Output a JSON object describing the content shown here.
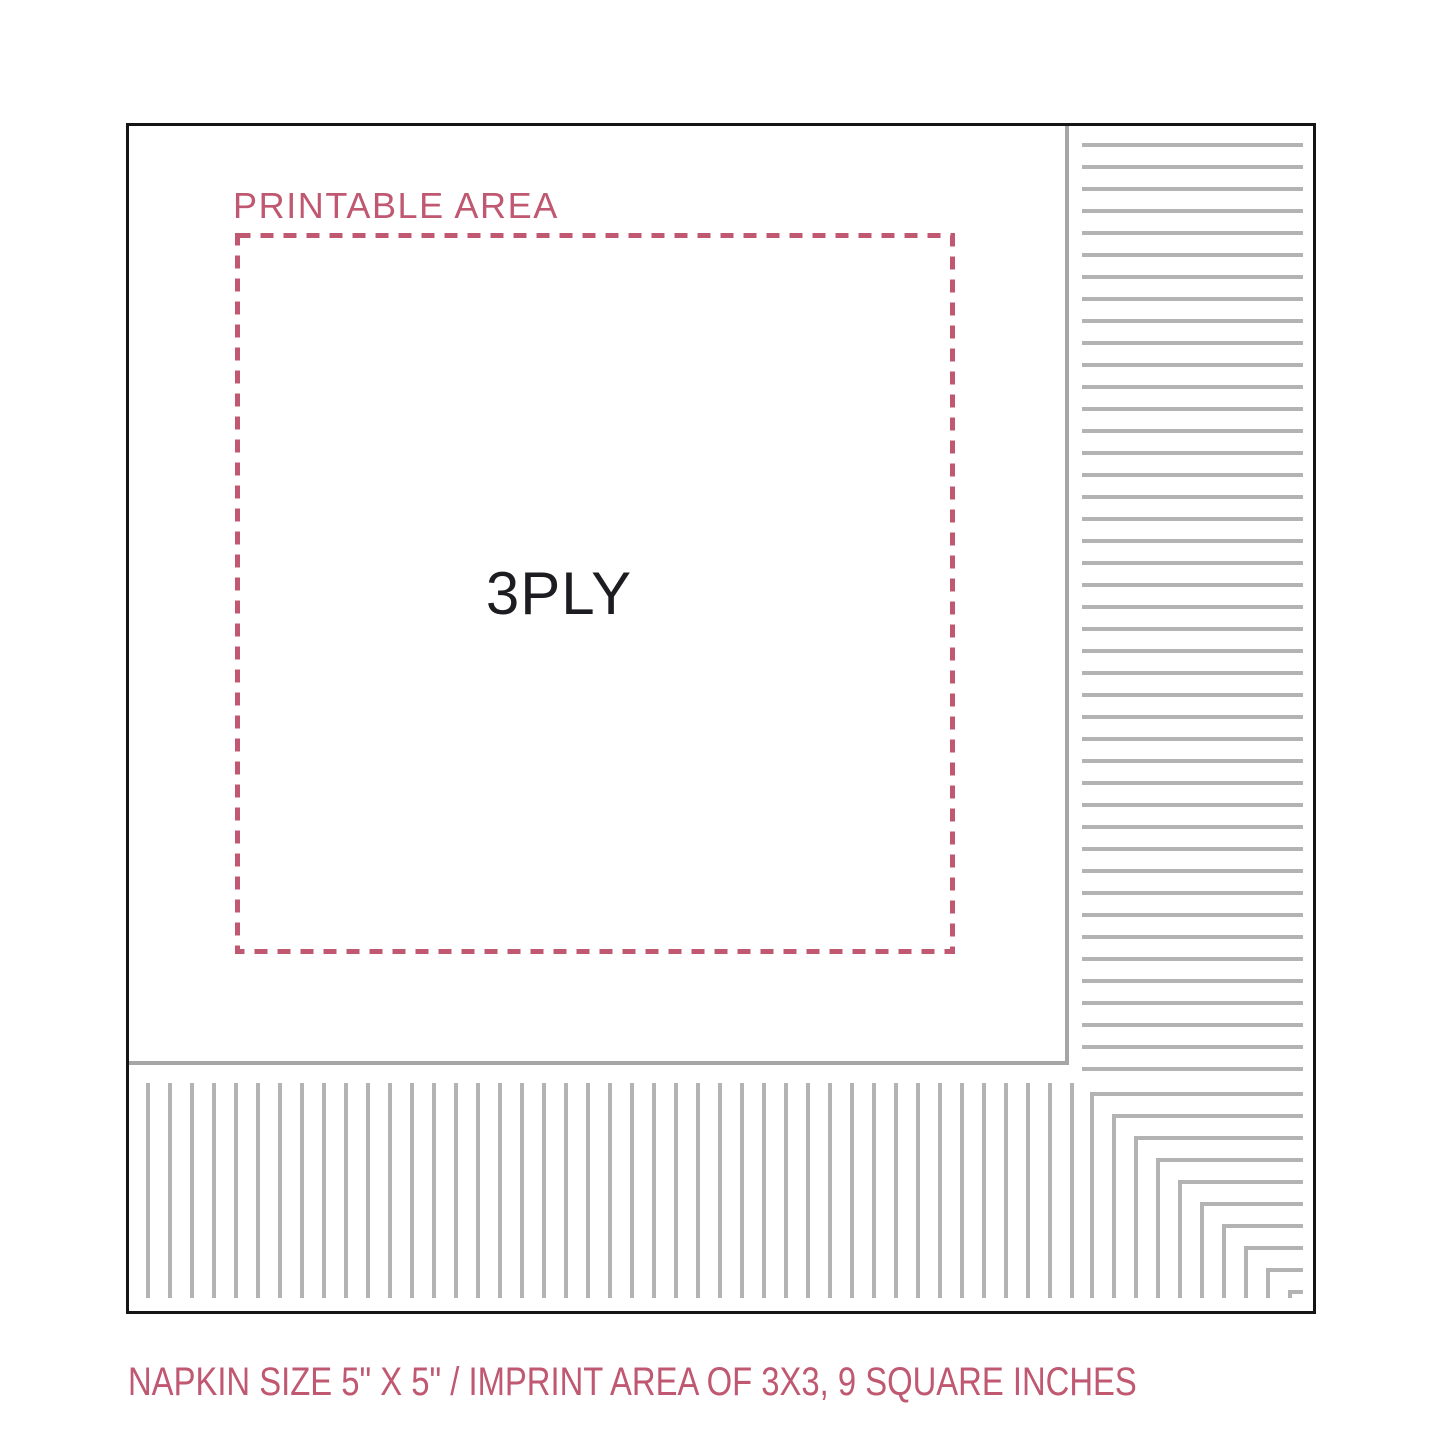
{
  "diagram": {
    "printable_area_label": "PRINTABLE AREA",
    "ply_label": "3PLY",
    "caption": "NAPKIN SIZE 5\" X 5\" / IMPRINT AREA OF 3X3, 9 SQUARE INCHES",
    "specs": {
      "napkin_size": "5\" X 5\"",
      "imprint_area": "3X3",
      "imprint_square_inches": "9",
      "ply": "3PLY"
    },
    "colors": {
      "accent_rose": "#bf5870",
      "pleat_gray": "#b3b3b3",
      "fold_edge_gray": "#a6a6a6",
      "border_black": "#151515"
    }
  }
}
